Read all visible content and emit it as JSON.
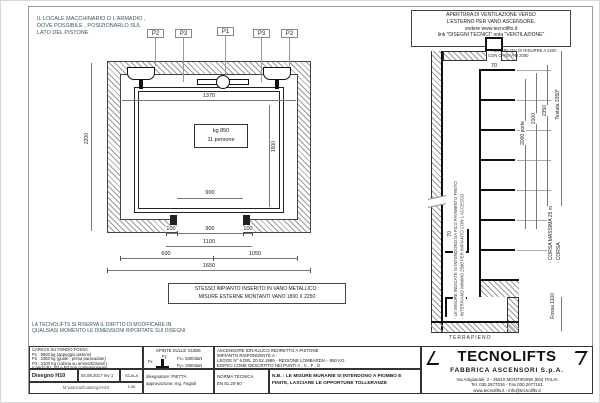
{
  "notes": {
    "machine_room": "IL LOCALE MACCHINARIO O L'ARMADIO ,\nDOVE POSSIBILE ,  POSIZIONARLO SUL\nLATO DEL PISTONE",
    "reserve": "LA TECNOLIFTS SI RISERVA IL DIRITTO DI MODIFICARE IN\nQUALSIASI MOMENTO LE DIMENSIONI RIPORTATE SUI DISEGNI",
    "vent_box": "APERTURA DI VENTILAZIONE VERSO\nL'ESTERNO PER VANO ASCENSORE.\nvedere www.tecnolifts.it\nlink \"DISEGNI TECNICI\" nota \"VENTILAZIONE\"",
    "vent_asterisk": "* POSSIBILITA' DI RIDURRE A 2200\nCON CABINA H 2050"
  },
  "plan": {
    "labels": {
      "p1": "P1",
      "p2": "P2",
      "p3": "P3"
    },
    "cabin_plate": {
      "line1": "kg 850",
      "line2": "11 persone"
    },
    "dims": {
      "width": "1370",
      "depth": "1500",
      "door": "900",
      "shaft_depth": "2200",
      "jamb": "100",
      "door_clear": "900",
      "opening": "1100",
      "left": "600",
      "right": "1050",
      "total": "1650"
    },
    "metal_note": "STESSO IMPIANTO INSERITO IN VANO METALLICO :\nMISURE ESTERNE MONTANTI VANO 1800 X 2250"
  },
  "section": {
    "dims": {
      "d70": "70",
      "door_h": "2000 porte",
      "h2100": "2100",
      "h2350": "2350",
      "testata": "Testata 3350*",
      "corsa": "- CORSA MASSIMA 25 m\n- CORSA",
      "fossa": "Fossa 1100"
    },
    "ground_label": "TERRAPIENO",
    "side_note": "- LE MISURE INDICATE SI INTENDONO DA FILO PAVIMENTO FINITO\n- INTERPIANO MINIMO 2500 PER IMPIANTO CON 1 ACCESSO"
  },
  "titleblock": {
    "carichi": "CARICHI SU FONDO FOSSA :\nP1 : 6900 kg (appoggio pistone)\nP2 : 2350 kg (guide , presa paracadute)\nP3 : 3100 Kg (cabina su ammortizzatori)\n(carichi P1, P2 e P3 non contemporanei)",
    "disegno": "Disegno H10",
    "date_rev": "04.09.2017  rev 1",
    "scala": "SCALA 1:30",
    "filepath": "M:\\autocad\\catalogo\\H10",
    "spinte_title": "SPINTE SULLE GUIDE",
    "fy_label": "Fy",
    "fx_label": "Fx",
    "fx": "Fx= 5300daN",
    "fy": "Fy= 2000daN",
    "drafter": "disegnatore: PIETTA\napprovazione: Ing. Fagioli",
    "impianto": "ASCENSORE IDRAULICO INDIRETTO A PISTONE\nIMPIANTO RISPONDENTE A :\nLEGGE N° 6 DEL 20.02.1989 - REGIONE LOMBARDIA - 850 KG\nEDIFICI COME DESCRITTO NEI PUNTI  A , C , F , G",
    "norma": "NORMA TECNICA\nEN 81.20-50",
    "nb": "N.B. : LE MISURE MURARIE SI INTENDONO A PIOMBO E\nFINITE, LASCIARE LE OPPORTUNE TOLLERANZE",
    "logo": {
      "name": "TECNOLIFTS",
      "sub": "FABBRICA ASCENSORI S.p.A.",
      "addr1": "Via Artigianale, 2 - 25010 MONTIRONE (BS) ITALIA",
      "addr2": "Tel. 030.2677016 - Fax 030.2677161",
      "addr3": "www.tecnolifts.it - info@tecnolifts.it"
    }
  }
}
